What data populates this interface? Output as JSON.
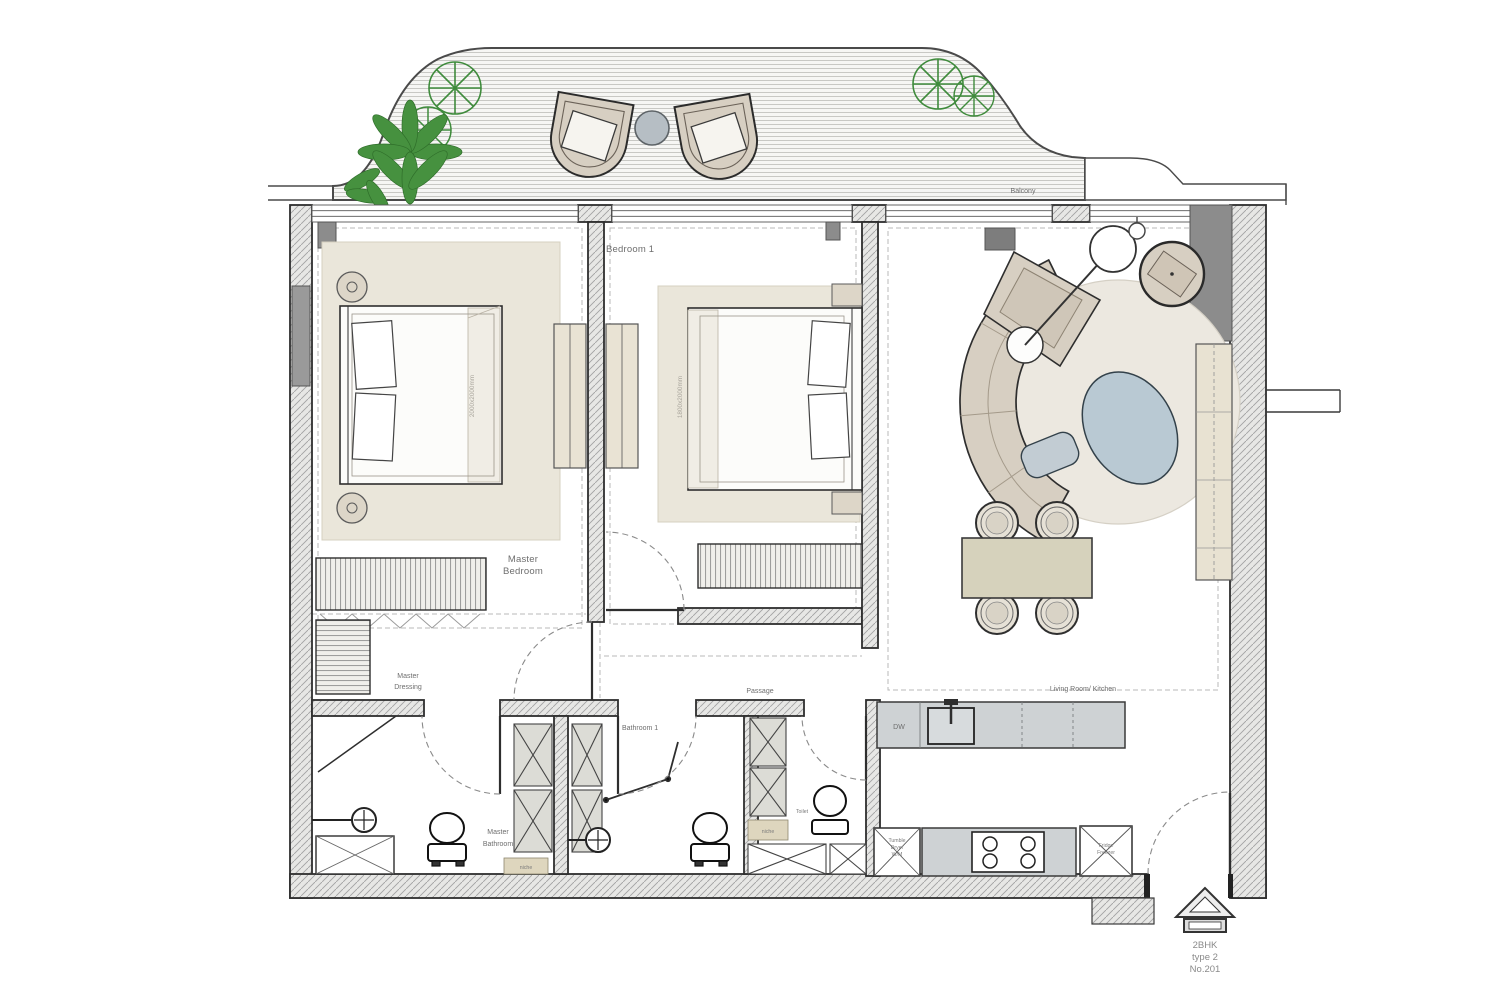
{
  "plan": {
    "labels": {
      "balcony": "Balcony",
      "bedroom1": "Bedroom 1",
      "master_l1": "Master",
      "master_l2": "Bedroom",
      "dressing_l1": "Master",
      "dressing_l2": "Dressing",
      "mbath_l1": "Master",
      "mbath_l2": "Bathroom",
      "bathroom1": "Bathroom 1",
      "toilet": "Toilet",
      "passage": "Passage",
      "living": "Living Room/ Kitchen",
      "niche1": "niche",
      "niche2": "niche",
      "dw": "DW",
      "washer_l1": "Tumble",
      "washer_l2": "Dryer",
      "washer_l3": "W/M",
      "fridge_l1": "Fridge",
      "fridge_l2": "Freezer",
      "master_bed_dim": "2000x2000mm",
      "bed1_dim": "1800x2000mm",
      "stamp_l1": "2BHK",
      "stamp_l2": "type 2",
      "stamp_l3": "No.201"
    },
    "colors": {
      "wall_fill": "#e7e7e5",
      "hatch_line": "#a3a3a3",
      "column_gray": "#8c8c8c",
      "furniture_beige": "#d7cfc2",
      "rug_beige": "#ece8e0",
      "bed_rug": "#eae6da",
      "accent_bluegray": "#b9c9d3",
      "dining_tan": "#d6d2bc",
      "counter_gray": "#ced2d4",
      "cabinet_cream": "#e8e2d2",
      "plant_green": "#3f8b3c",
      "line_dark": "#2e2e2e"
    }
  }
}
